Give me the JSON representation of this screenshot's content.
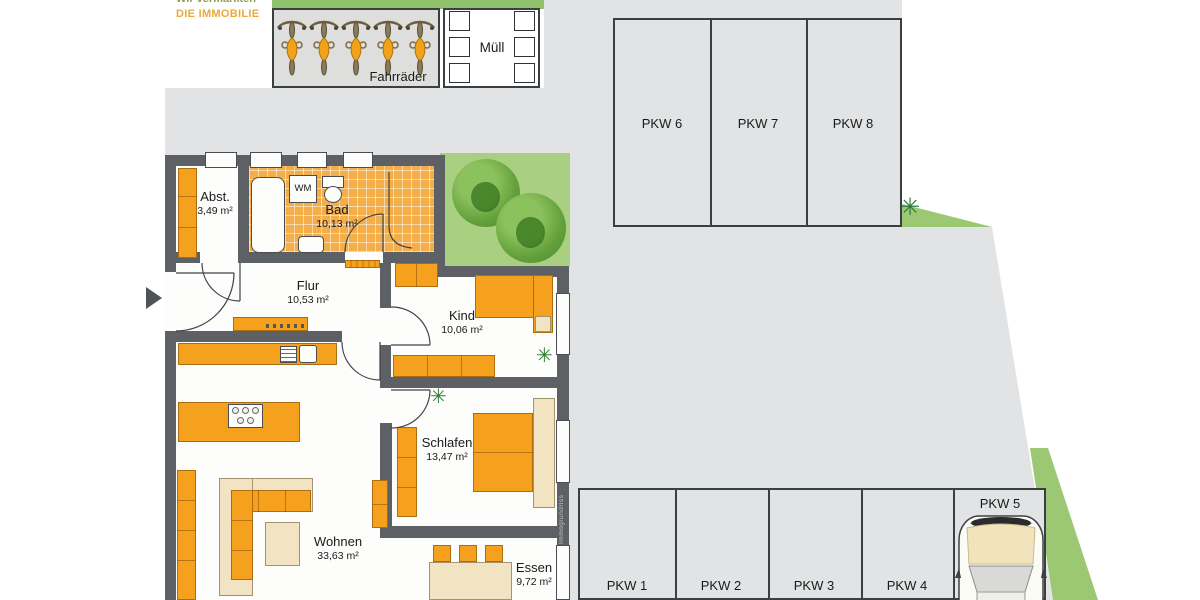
{
  "logo": {
    "line1": "Wir vermarkten",
    "line2": "DIE IMMOBILIE"
  },
  "outdoor": {
    "bike_area_label": "Fahrräder",
    "waste_area_label": "Müll"
  },
  "parking": {
    "top_row": [
      {
        "label": "PKW 6"
      },
      {
        "label": "PKW 7"
      },
      {
        "label": "PKW 8"
      }
    ],
    "bottom_row": [
      {
        "label": "PKW 1"
      },
      {
        "label": "PKW 2"
      },
      {
        "label": "PKW 3"
      },
      {
        "label": "PKW 4"
      },
      {
        "label": "PKW 5"
      }
    ]
  },
  "apartment": {
    "rooms": [
      {
        "name": "Abst.",
        "area": "3,49 m²"
      },
      {
        "name": "Bad",
        "area": "10,13 m²"
      },
      {
        "name": "Flur",
        "area": "10,53 m²"
      },
      {
        "name": "Kind",
        "area": "10,06 m²"
      },
      {
        "name": "Schlafen",
        "area": "13,47 m²"
      },
      {
        "name": "Wohnen",
        "area": "33,63 m²"
      },
      {
        "name": "Essen",
        "area": "9,72 m²"
      }
    ],
    "appliance_labels": {
      "washing_machine": "WM"
    },
    "watermark": "Immogrundriss"
  },
  "colors": {
    "furniture_orange": "#f5a11e",
    "wall_gray": "#5d6165",
    "driveway_gray": "#e2e3e4",
    "garden_green": "#a9cf80",
    "hedge_green": "#8fc16c",
    "logo_green": "#8d9a55",
    "logo_orange": "#e9a93c",
    "beige": "#f2e3c3"
  }
}
